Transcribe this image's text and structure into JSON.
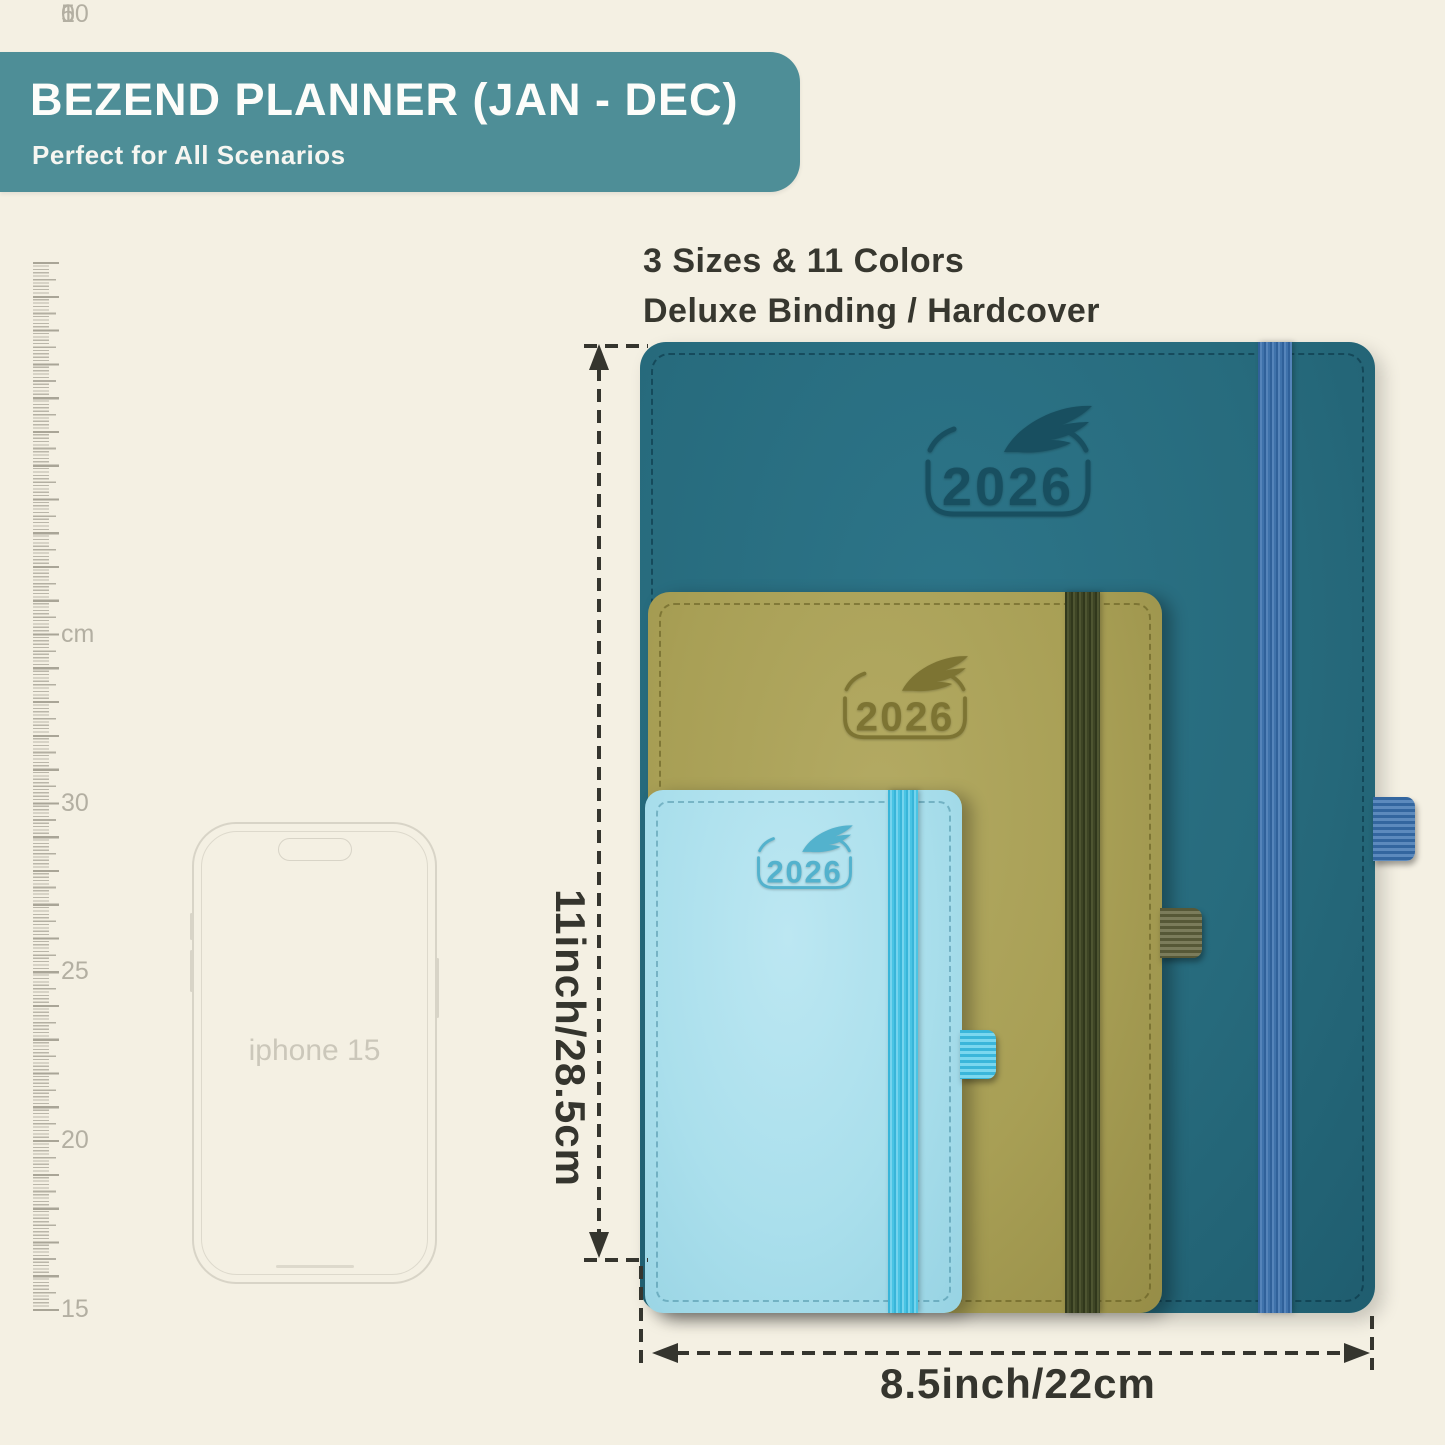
{
  "header": {
    "title": "BEZEND PLANNER (JAN - DEC)",
    "subtitle": "Perfect for All Scenarios",
    "banner_color": "#4e8e97"
  },
  "features": {
    "line1": "3 Sizes & 11 Colors",
    "line2": "Deluxe Binding / Hardcover"
  },
  "ruler": {
    "unit": "cm",
    "marks": [
      "30",
      "25",
      "20",
      "15",
      "10",
      "5",
      "0"
    ]
  },
  "phone": {
    "label": "iphone 15"
  },
  "emblem": {
    "year": "2026"
  },
  "planners": [
    {
      "id": "large",
      "cover_color": "#276b7d",
      "band_color": "#3f72ab"
    },
    {
      "id": "medium",
      "cover_color": "#a89f55",
      "band_color": "#3e4525"
    },
    {
      "id": "small",
      "cover_color": "#aadfec",
      "band_color": "#49c4e4"
    }
  ],
  "dimensions": {
    "height_label": "11inch/28.5cm",
    "width_label": "8.5inch/22cm"
  }
}
